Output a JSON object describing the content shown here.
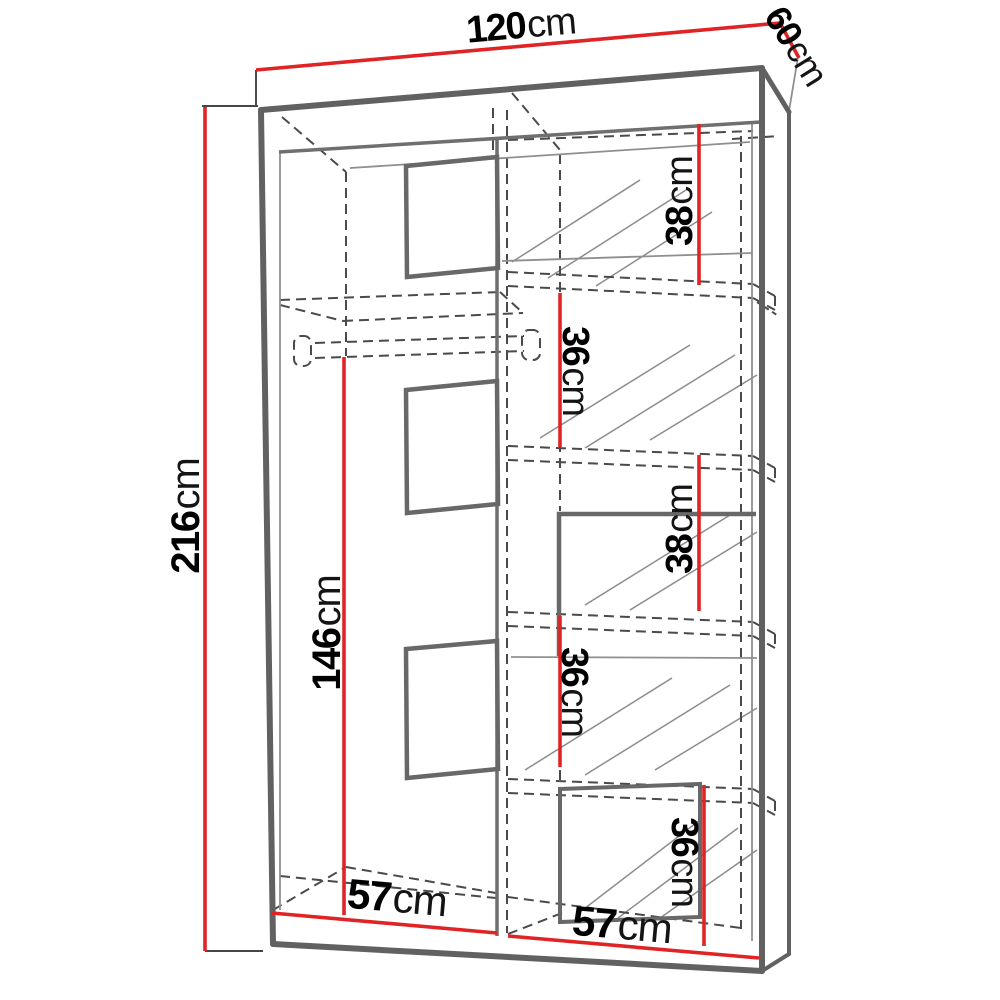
{
  "diagram": {
    "subject": "Sliding-door wardrobe technical drawing with dimension lines",
    "unit": "cm",
    "overall": {
      "width": "120",
      "depth": "60",
      "height": "216"
    },
    "labels": {
      "width_top": {
        "value": "120",
        "unit": "cm"
      },
      "depth_top": {
        "value": "60",
        "unit": "cm"
      },
      "height_left": {
        "value": "216",
        "unit": "cm"
      },
      "hanging_height": {
        "value": "146",
        "unit": "cm"
      },
      "shelf_gap_1": {
        "value": "38",
        "unit": "cm"
      },
      "shelf_gap_2": {
        "value": "36",
        "unit": "cm"
      },
      "shelf_gap_3": {
        "value": "38",
        "unit": "cm"
      },
      "shelf_gap_4": {
        "value": "36",
        "unit": "cm"
      },
      "shelf_gap_5": {
        "value": "36",
        "unit": "cm"
      },
      "section_width_left": {
        "value": "57",
        "unit": "cm"
      },
      "section_width_right": {
        "value": "57",
        "unit": "cm"
      }
    },
    "colors": {
      "dimension_line": "#e02425",
      "structure": "#666666",
      "hidden_lines": "#4a4a4a",
      "text": "#000000",
      "background": "#ffffff"
    }
  }
}
